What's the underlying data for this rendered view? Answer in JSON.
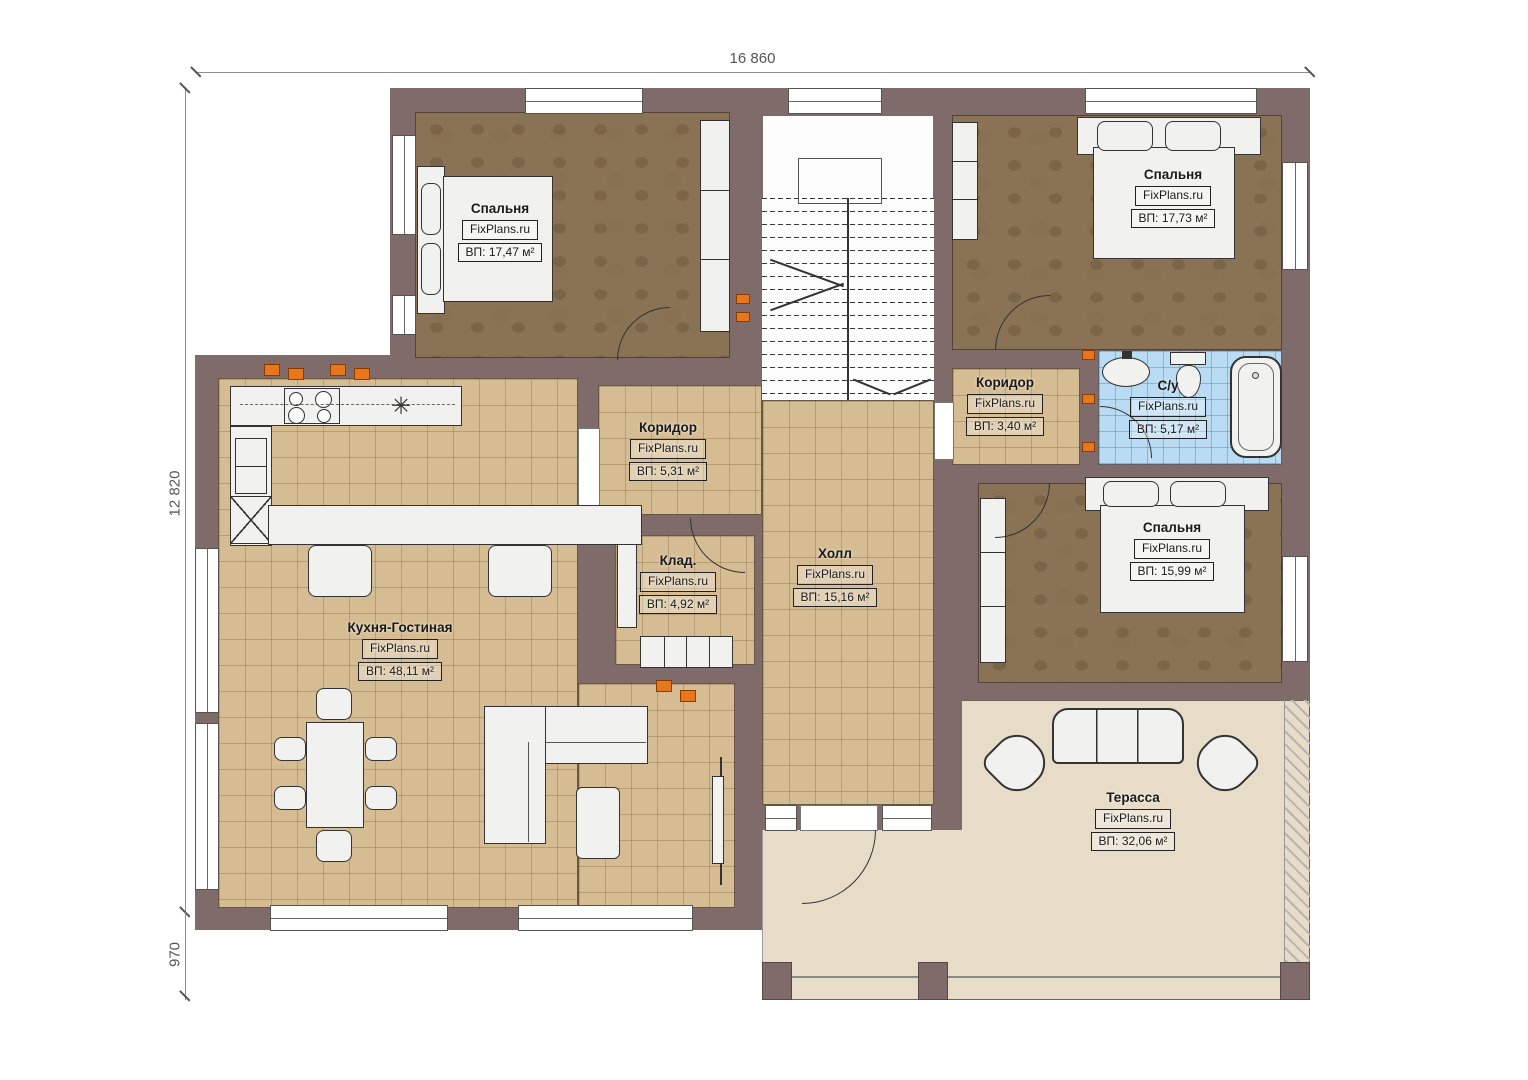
{
  "plan": {
    "watermark": "FixPlans.ru",
    "dimensions": {
      "top": "16 860",
      "left": "12 820",
      "bottom_left": "970"
    },
    "rooms": [
      {
        "id": "bedroom-1",
        "name": "Спальня",
        "area": "ВП: 17,47 м²"
      },
      {
        "id": "bedroom-2",
        "name": "Спальня",
        "area": "ВП: 17,73 м²"
      },
      {
        "id": "corridor-center",
        "name": "Коридор",
        "area": "ВП: 5,31 м²"
      },
      {
        "id": "corridor-right",
        "name": "Коридор",
        "area": "ВП: 3,40 м²"
      },
      {
        "id": "bathroom",
        "name": "С/у",
        "area": "ВП: 5,17 м²"
      },
      {
        "id": "bedroom-3",
        "name": "Спальня",
        "area": "ВП: 15,99 м²"
      },
      {
        "id": "storage",
        "name": "Клад.",
        "area": "ВП: 4,92 м²"
      },
      {
        "id": "hall",
        "name": "Холл",
        "area": "ВП: 15,16 м²"
      },
      {
        "id": "kitchen-living",
        "name": "Кухня-Гостиная",
        "area": "ВП: 48,11 м²"
      },
      {
        "id": "terrace",
        "name": "Терасса",
        "area": "ВП: 32,06 м²"
      }
    ],
    "symbols": {
      "sink_star": "✳"
    },
    "colors": {
      "wall": "#7e6b6a",
      "bedroom_floor": "#8a7355",
      "tile_floor": "#d5bc92",
      "bath_floor": "#b9dbf3",
      "terrace_floor": "#e7dcc7",
      "furniture": "#f1f1ef",
      "accent_orange": "#e8771c"
    }
  }
}
